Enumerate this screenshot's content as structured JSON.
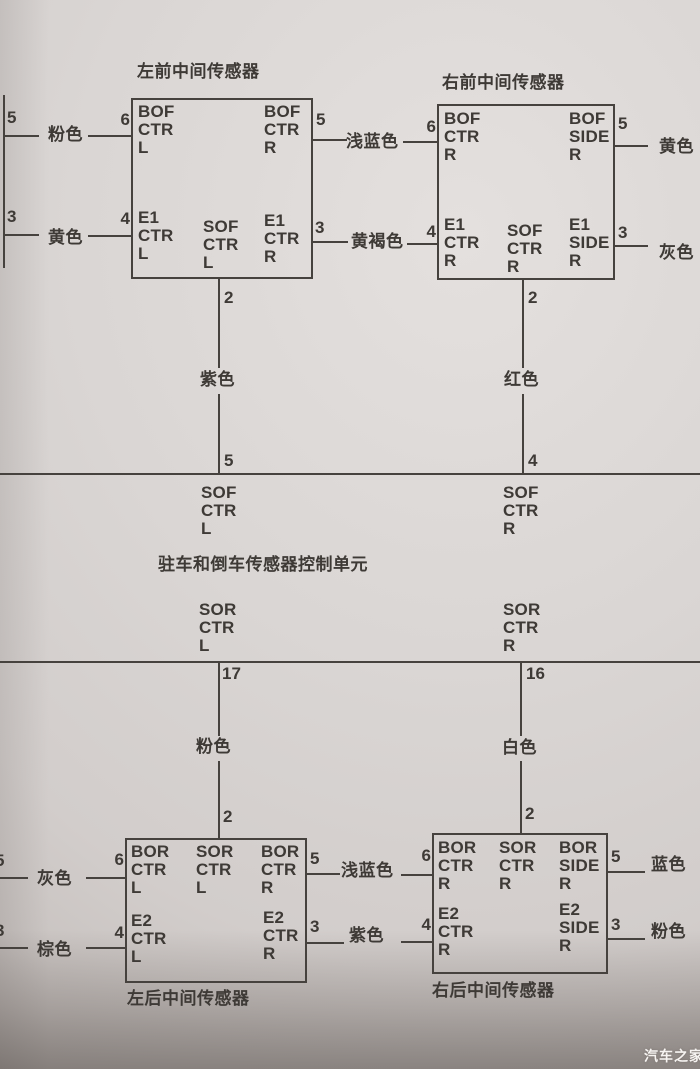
{
  "colors": {
    "ink": "#46423e",
    "paper": "#d9d5d3"
  },
  "watermark": "汽车之家",
  "front_left": {
    "title": "左前中间传感器",
    "ports": {
      "tl": "BOF\nCTR\nL",
      "tr": "BOF\nCTR\nR",
      "bl": "E1\nCTR\nL",
      "bc": "SOF\nCTR\nL",
      "br": "E1\nCTR\nR"
    },
    "pins": {
      "p6": "6",
      "p4": "4",
      "p5": "5",
      "p3": "3",
      "p2": "2"
    }
  },
  "front_right": {
    "title": "右前中间传感器",
    "ports": {
      "tl": "BOF\nCTR\nR",
      "tr": "BOF\nSIDE\nR",
      "bl": "E1\nCTR\nR",
      "bc": "SOF\nCTR\nR",
      "br": "E1\nSIDE\nR"
    },
    "pins": {
      "p6": "6",
      "p4": "4",
      "p5": "5",
      "p3": "3",
      "p2": "2"
    }
  },
  "front_stub": {
    "p5": "5",
    "p3": "3"
  },
  "front_wires": {
    "pink": "粉色",
    "yellow": "黄色",
    "light_blue": "浅蓝色",
    "tan": "黄褐色",
    "yellow_right": "黄色",
    "gray": "灰色",
    "purple": "紫色",
    "red": "红色"
  },
  "control_unit": {
    "title": "驻车和倒车传感器控制单元",
    "top_pin_left": "5",
    "top_pin_right": "4",
    "top_port_left": "SOF\nCTR\nL",
    "top_port_right": "SOF\nCTR\nR",
    "bottom_port_left": "SOR\nCTR\nL",
    "bottom_port_right": "SOR\nCTR\nR",
    "bottom_pin_left": "17",
    "bottom_pin_right": "16"
  },
  "rear_wires": {
    "pink": "粉色",
    "white": "白色",
    "gray": "灰色",
    "brown": "棕色",
    "light_blue": "浅蓝色",
    "purple": "紫色",
    "blue": "蓝色",
    "pink_right": "粉色"
  },
  "rear_stub": {
    "p5": "5",
    "p3": "3"
  },
  "rear_left": {
    "title": "左后中间传感器",
    "ports": {
      "tl": "BOR\nCTR\nL",
      "tc": "SOR\nCTR\nL",
      "tr": "BOR\nCTR\nR",
      "bl": "E2\nCTR\nL",
      "br": "E2\nCTR\nR"
    },
    "pins": {
      "p2": "2",
      "p6": "6",
      "p4": "4",
      "p5": "5",
      "p3": "3"
    }
  },
  "rear_right": {
    "title": "右后中间传感器",
    "ports": {
      "tl": "BOR\nCTR\nR",
      "tc": "SOR\nCTR\nR",
      "tr": "BOR\nSIDE\nR",
      "bl": "E2\nCTR\nR",
      "br": "E2\nSIDE\nR"
    },
    "pins": {
      "p2": "2",
      "p6": "6",
      "p4": "4",
      "p5": "5",
      "p3": "3"
    }
  }
}
